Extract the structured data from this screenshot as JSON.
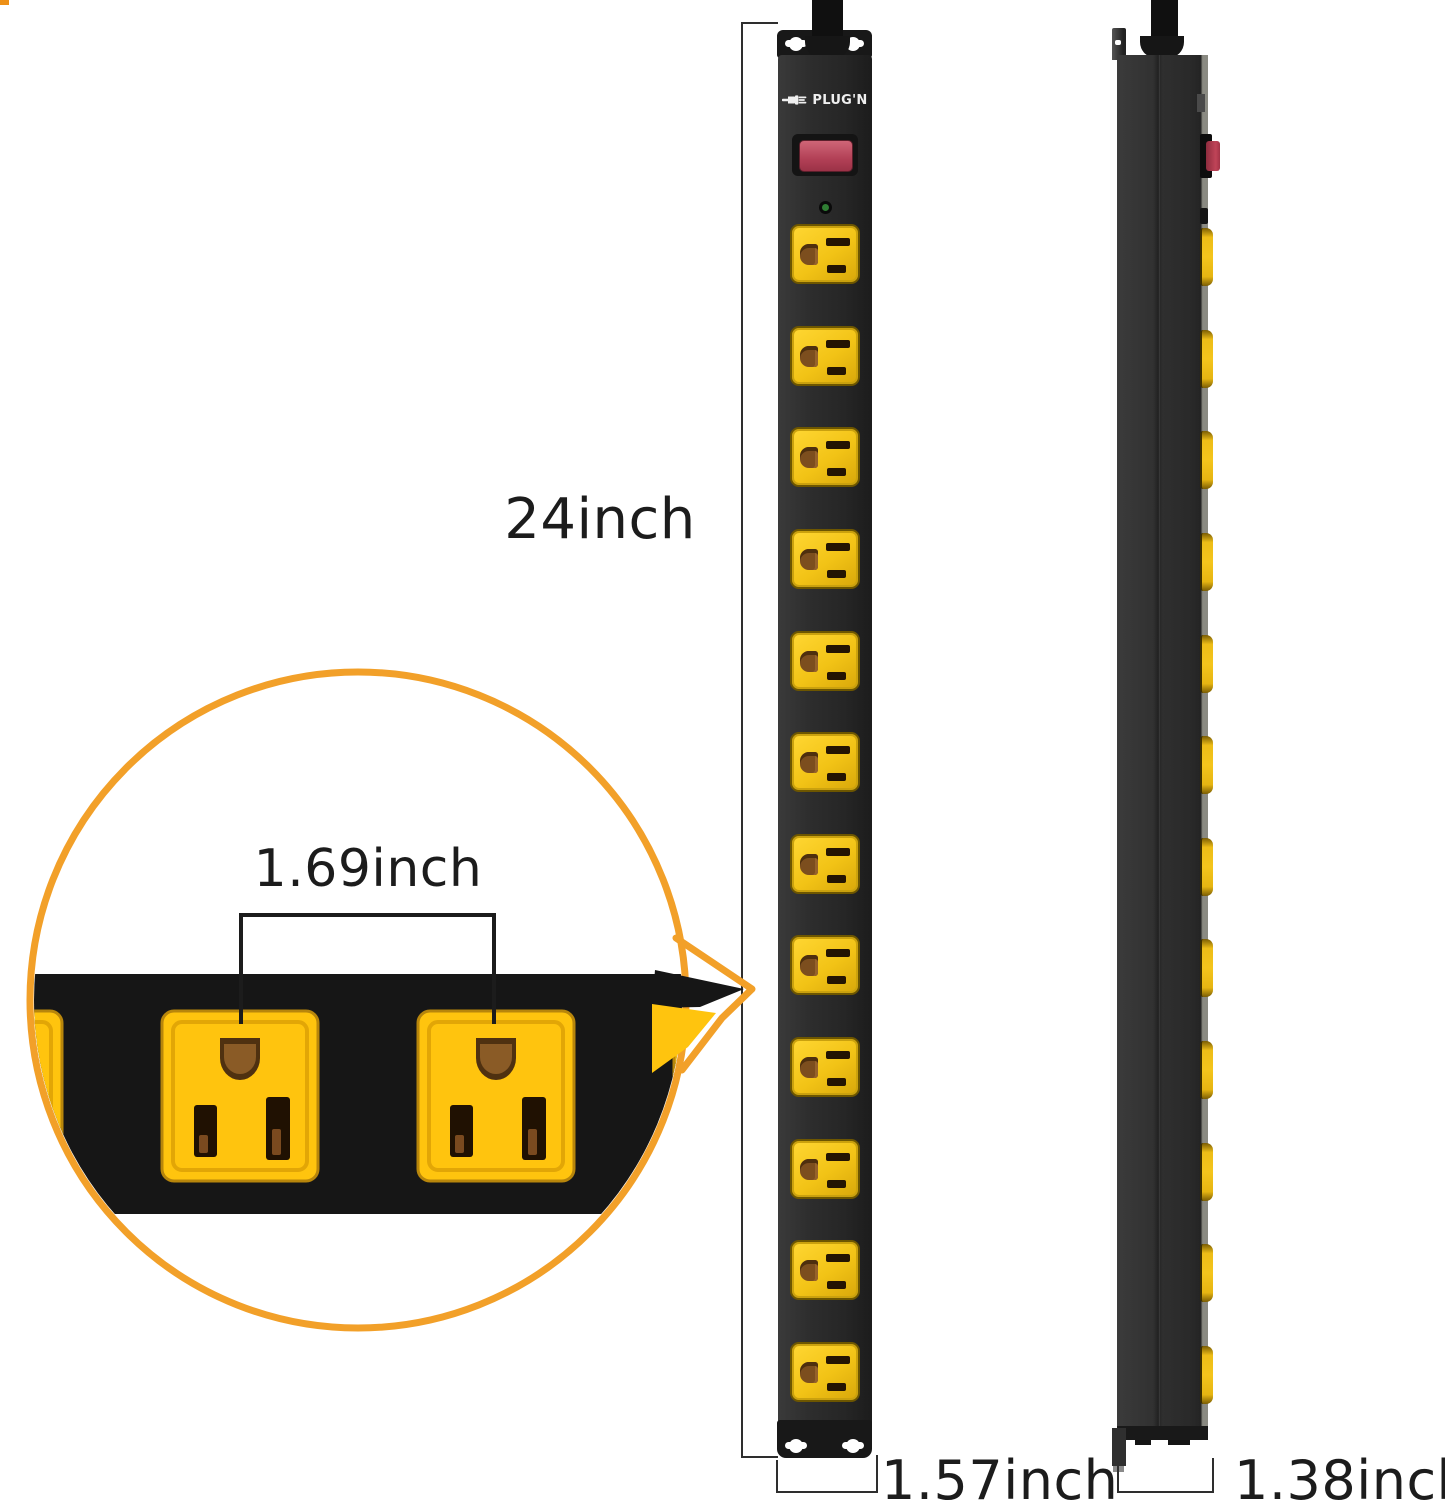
{
  "labels": {
    "height": "24inch",
    "width": "1.57inch",
    "depth": "1.38inch",
    "outlet_spacing": "1.69inch"
  },
  "brand": {
    "name": "PLUG'N"
  },
  "front_view": {
    "description": "power strip front view",
    "outlet_count": 12,
    "has_power_switch": true,
    "has_indicator_light": true,
    "mount_keyholes_per_bracket": 2
  },
  "side_view": {
    "description": "power strip side profile view",
    "outlet_count": 12,
    "has_power_switch": true
  },
  "callout": {
    "label": "1.69inch",
    "full_outlets_visible": 2
  },
  "colors": {
    "accent_orange": "#F2A029",
    "outlet_yellow": "#F6C51D",
    "body_black": "#2B2B2B",
    "band_black": "#161616",
    "switch_red": "#B84358",
    "led_green": "#2F7D33",
    "corner_mark": "#ED9017"
  }
}
